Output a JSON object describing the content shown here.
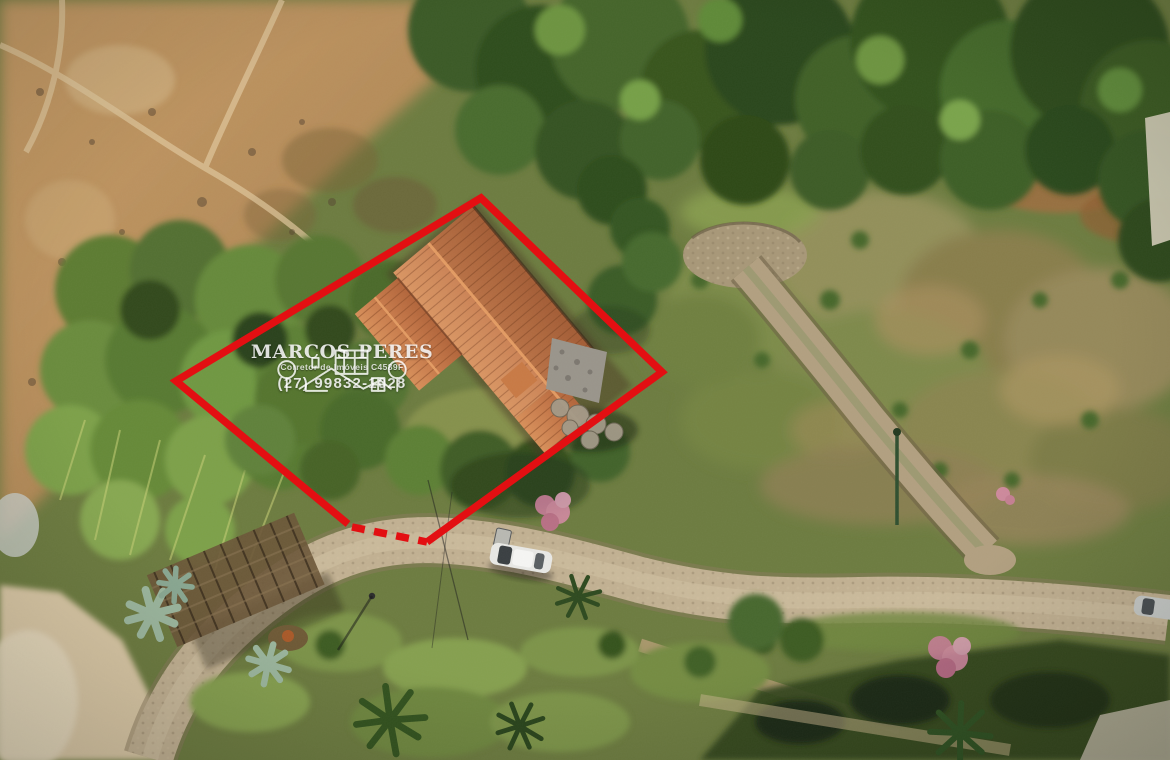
{
  "meta": {
    "type": "aerial-drone-photograph",
    "subject": "rural lot with tile-roof house outlined in red for sale listing"
  },
  "watermark": {
    "name": "MARCOS PERES",
    "subtitle": "Corretor de Imóveis C4589F",
    "phone": "(27) 99832-1028",
    "logo": "houses-and-trees-line-art"
  },
  "overlay": {
    "boundary_color": "#e30f12",
    "boundary_style": "solid red diamond outline with dashed segment along the road frontage (lower-left edge)"
  },
  "scene": {
    "elements": [
      "terracotta-tile-roof house with stone annex",
      "red property boundary outline",
      "dense green forest (top)",
      "dry brown hillside with dirt trails (top-left)",
      "grassy hill with dry patches (right)",
      "cobblestone walking path and cul-de-sac (right)",
      "main dirt/gravel road (bottom)",
      "white car parked on road",
      "wooden entrance pergola (bottom-left)",
      "agave plants and palm trees",
      "pink flowering trees",
      "sandy ground (bottom-left corner)"
    ]
  }
}
